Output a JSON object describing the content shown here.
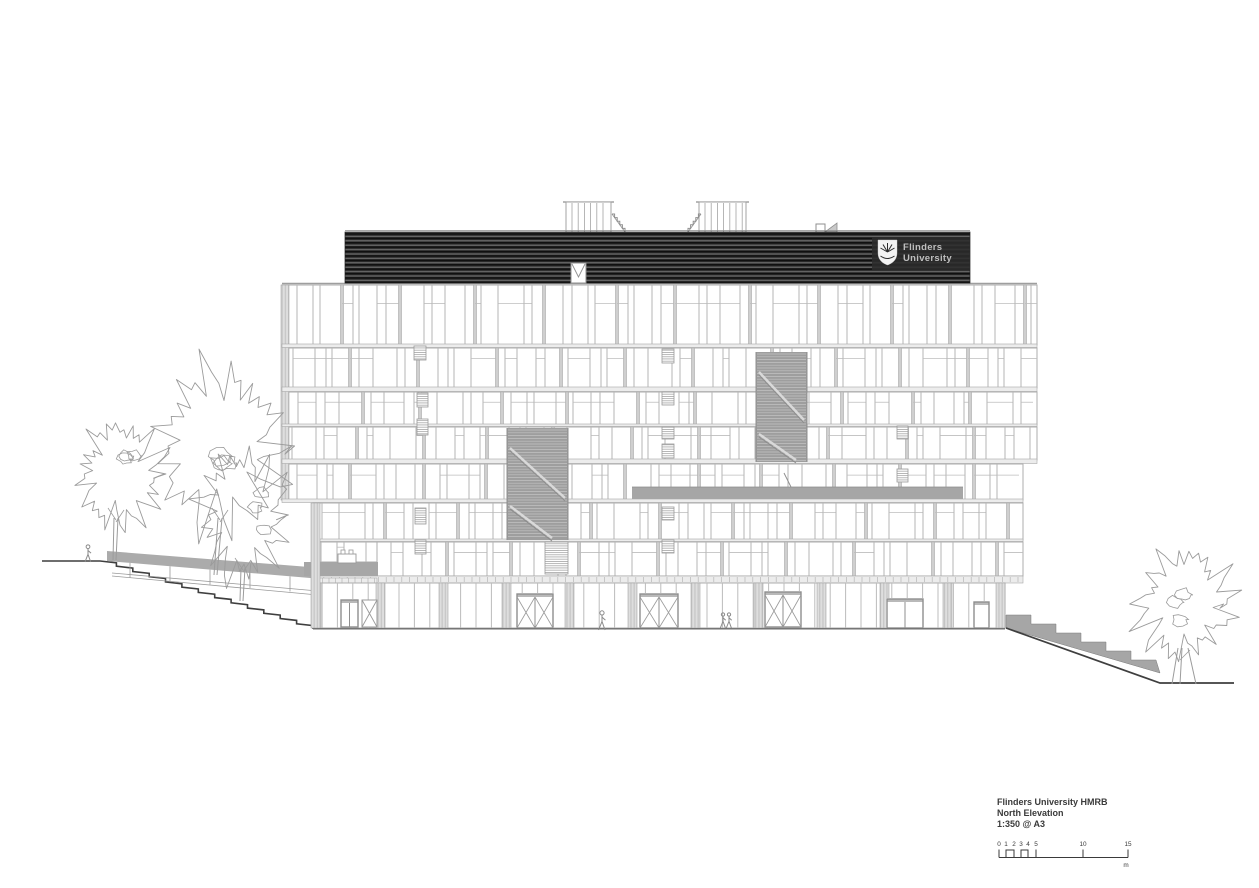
{
  "drawing_title_block": {
    "project": "Flinders University HMRB",
    "drawing_name": "North Elevation",
    "scale_note": "1:350 @ A3"
  },
  "scale_bar": {
    "labels": [
      "0",
      "1",
      "2",
      "3",
      "4",
      "5",
      "10",
      "15"
    ],
    "unit": "m"
  },
  "building_signage": {
    "logo_line1": "Flinders",
    "logo_line2": "University"
  },
  "colors": {
    "paper": "#ffffff",
    "facade_line": "#b5b5b5",
    "heavy_line": "#3f3f3f",
    "roof_band_dark": "#2e2e2e",
    "stair_screen_gray": "#9e9e9e",
    "canopy_gray": "#a6a6a6",
    "text_dark": "#3a3a3a",
    "logo_text": "#c0c0c0"
  }
}
